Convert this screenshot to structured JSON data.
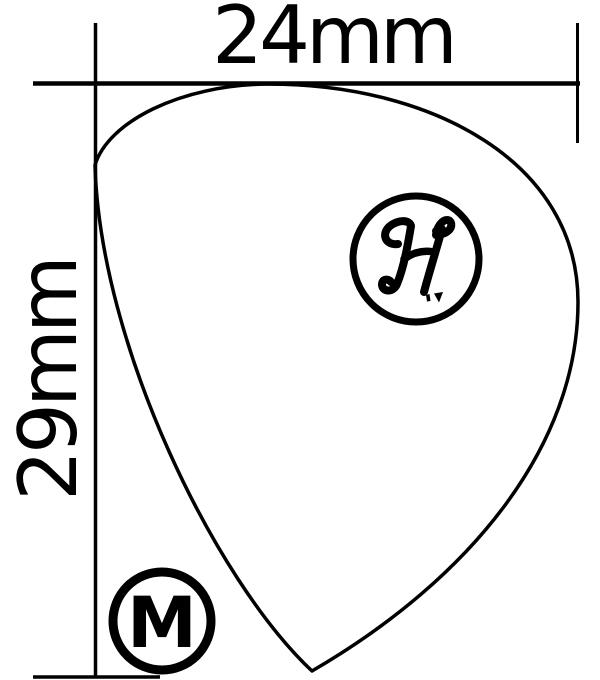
{
  "figure": {
    "description": "Technical outline drawing of a pointed teardrop guitar pick with width and height dimension lines",
    "background_color": "#ffffff",
    "line_color": "#000000"
  },
  "dimensions": {
    "width": {
      "label": "24mm"
    },
    "height": {
      "label": "29mm"
    }
  },
  "badges": {
    "brand_monogram": "H",
    "size_letter": "M"
  }
}
